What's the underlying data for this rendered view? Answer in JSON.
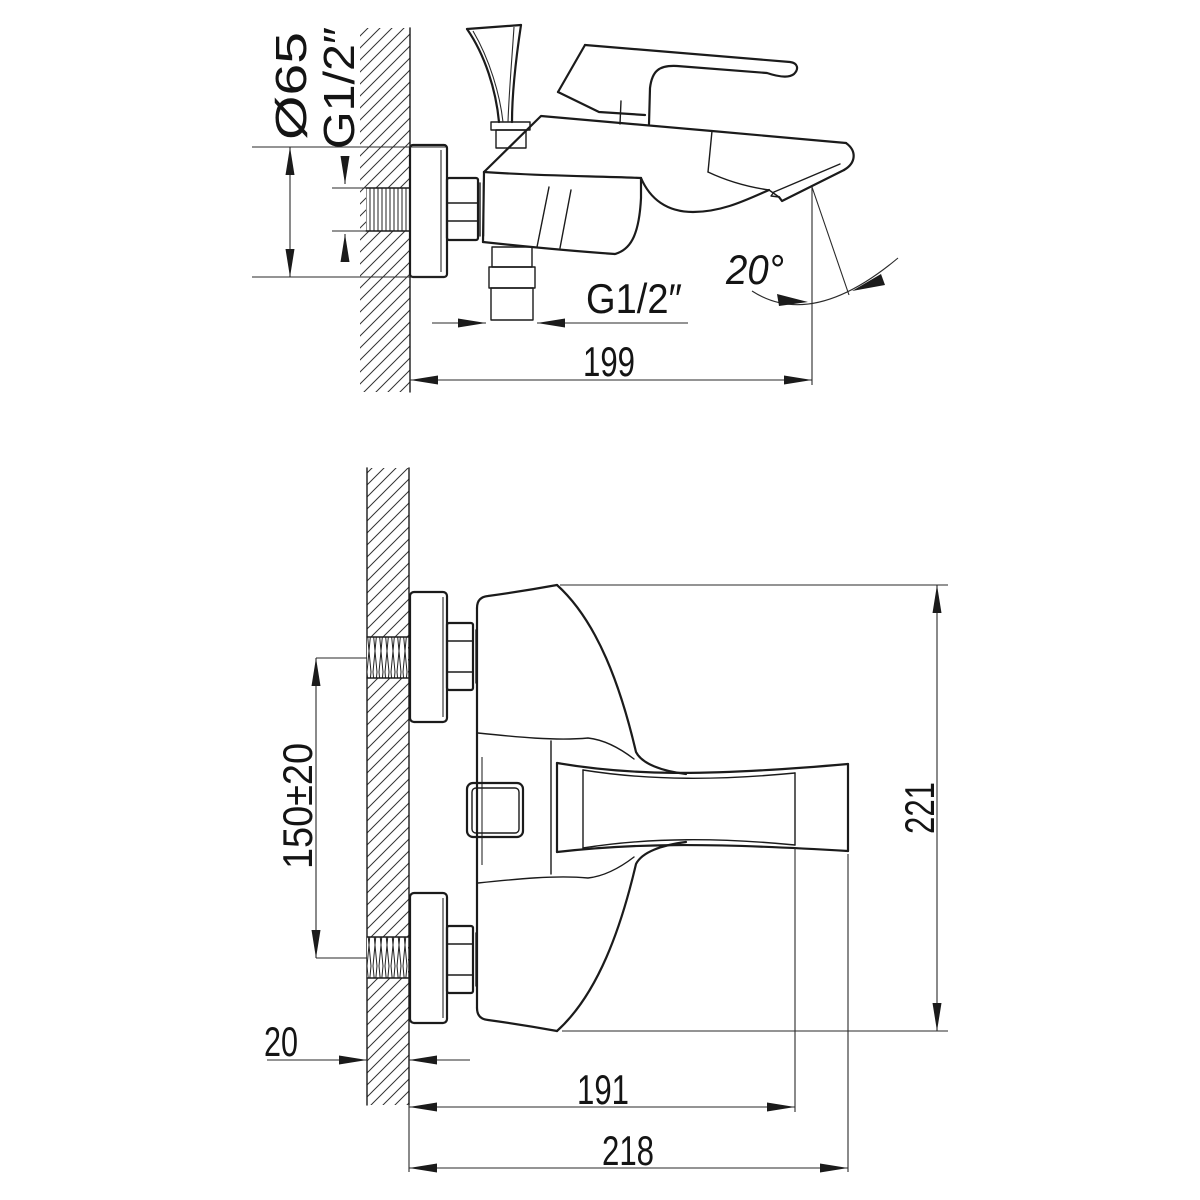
{
  "meta": {
    "background": "#ffffff",
    "line_color": "#1b1b1b",
    "drawing_type": "bath mixer faucet installation dimensions, two orthographic views"
  },
  "side_view": {
    "labels": {
      "flange_diameter": "Ø65",
      "inlet_thread": "G1/2″",
      "outlet_thread": "G1/2″",
      "spout_angle": "20°",
      "projection": "199"
    }
  },
  "front_view": {
    "labels": {
      "inlet_spacing": "150±20",
      "wall_thickness": "20",
      "spout_projection": "191",
      "overall_projection": "218",
      "overall_height": "221"
    }
  }
}
